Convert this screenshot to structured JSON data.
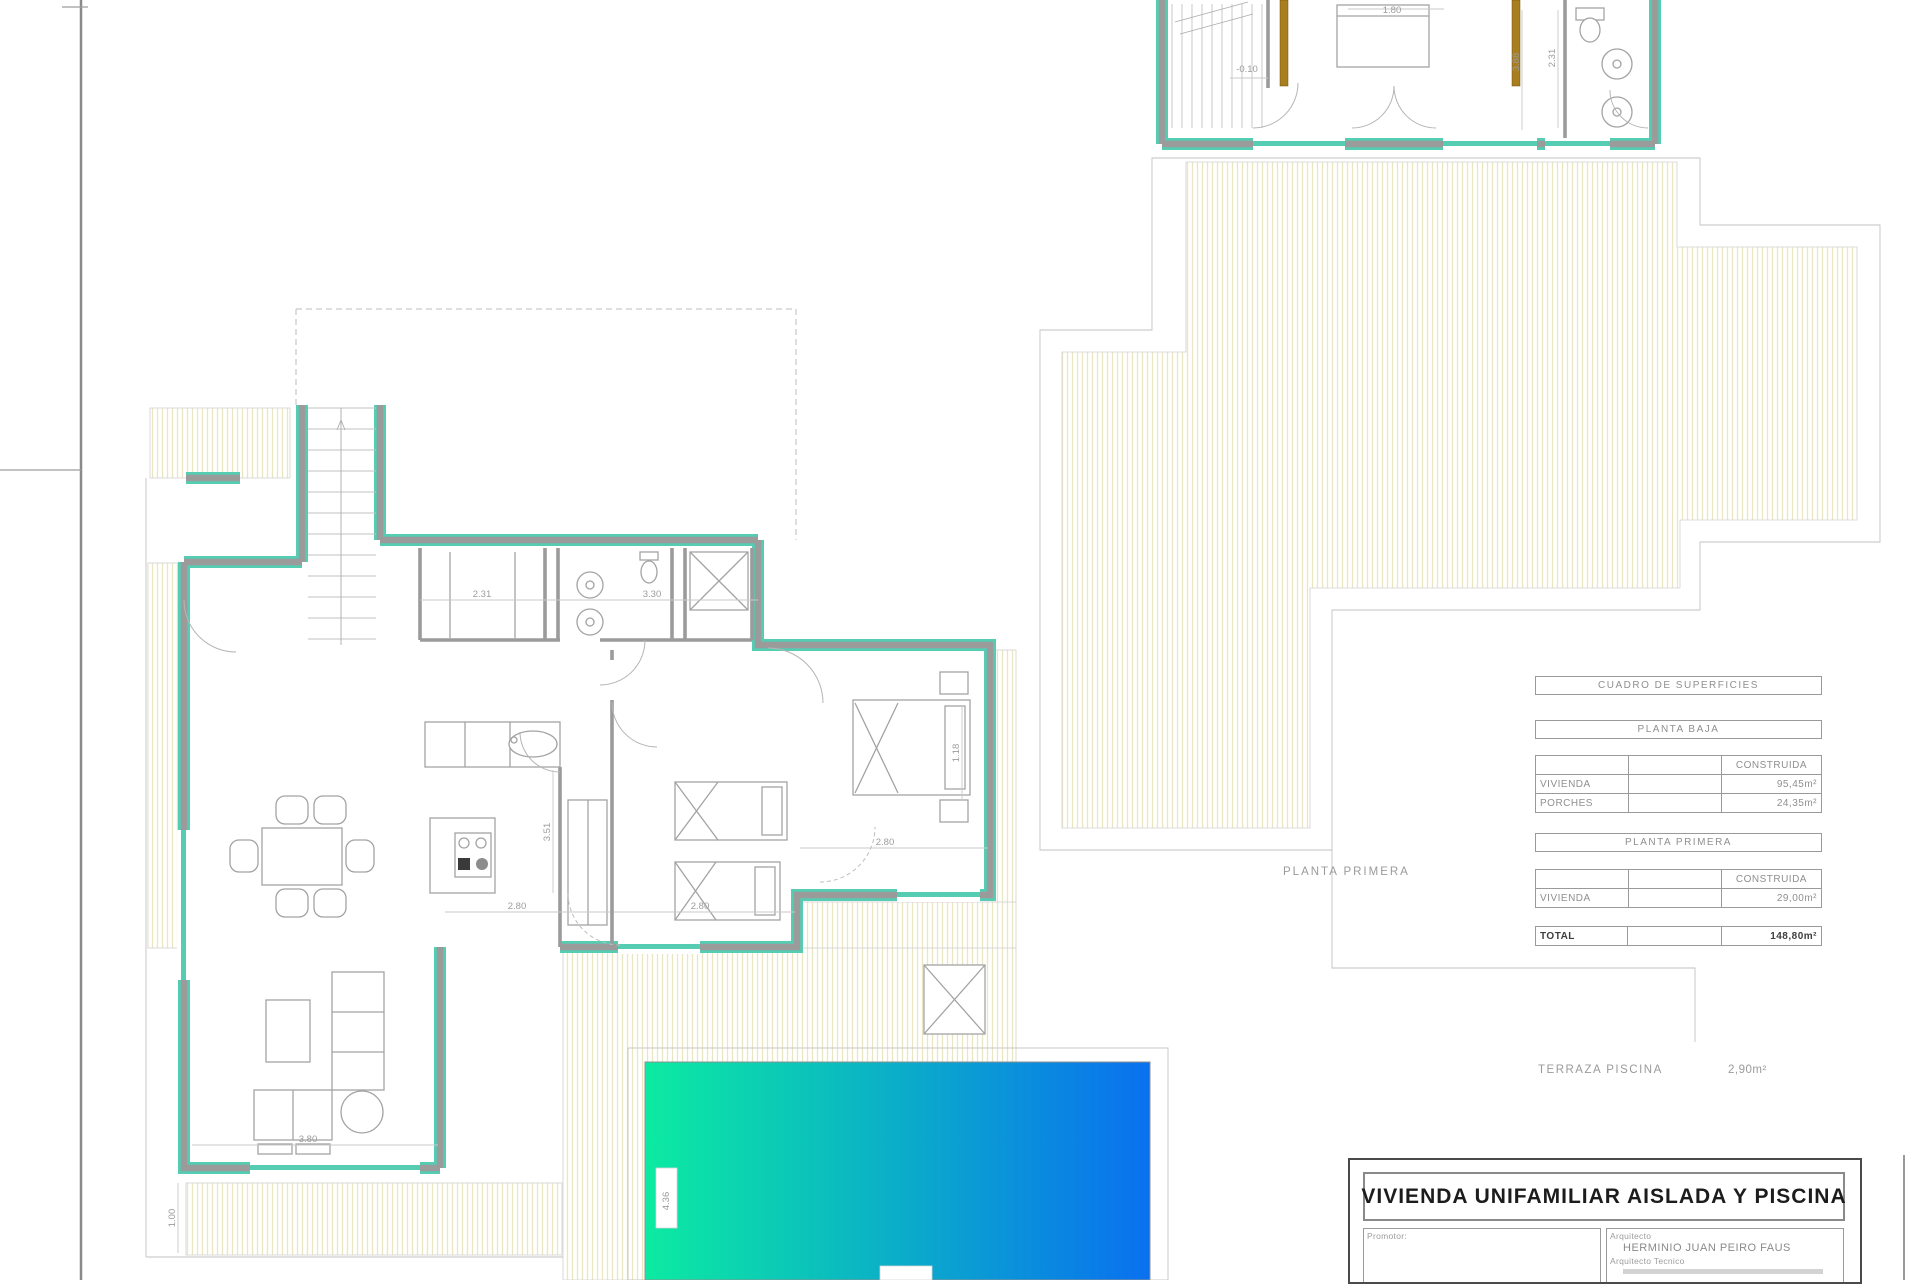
{
  "plan_labels": {
    "first_floor": "PLANTA PRIMERA"
  },
  "surface_table": {
    "title": "CUADRO DE SUPERFICIES",
    "col_header": "CONSTRUIDA",
    "planta_baja": {
      "name": "PLANTA BAJA",
      "rows": [
        {
          "label": "VIVIENDA",
          "value": "95,45m²"
        },
        {
          "label": "PORCHES",
          "value": "24,35m²"
        }
      ]
    },
    "planta_primera": {
      "name": "PLANTA PRIMERA",
      "rows": [
        {
          "label": "VIVIENDA",
          "value": "29,00m²"
        }
      ]
    },
    "total": {
      "label": "TOTAL",
      "value": "148,80m²"
    }
  },
  "terraza_piscina": {
    "label": "TERRAZA PISCINA",
    "value": "2,90m²"
  },
  "title_block": {
    "project_title": "VIVIENDA UNIFAMILIAR AISLADA Y PISCINA",
    "promotor_label": "Promotor:",
    "arquitecto_label": "Arquitecto",
    "arquitecto_name": "HERMINIO JUAN PEIRO FAUS",
    "arquitecto_tecnico_label": "Arquitecto Tecnico"
  },
  "dimensions": {
    "corridor_a": "2.31",
    "corridor_b": "3.30",
    "kitchen_width": "2.80",
    "bedroom_mid_width": "2.80",
    "bedroom_right_width": "2.80",
    "living_width": "3.80",
    "porch_depth": "1.00",
    "island_depth": "3.51",
    "bedroom_right_depth": "1.18",
    "pool_width": "4.36",
    "upper_bed_width": "1.80",
    "upper_level": "-0.10",
    "upper_depth_a": "3.88",
    "upper_depth_b": "2.31"
  },
  "colors": {
    "wall_accent": "#55CDB3",
    "wall_core": "#9B9B9B",
    "pool_gradient_start": "#0CEBA1",
    "pool_gradient_end": "#0A70F0",
    "hatch_line": "#EAE6C4",
    "wood": "#A87E1F"
  }
}
